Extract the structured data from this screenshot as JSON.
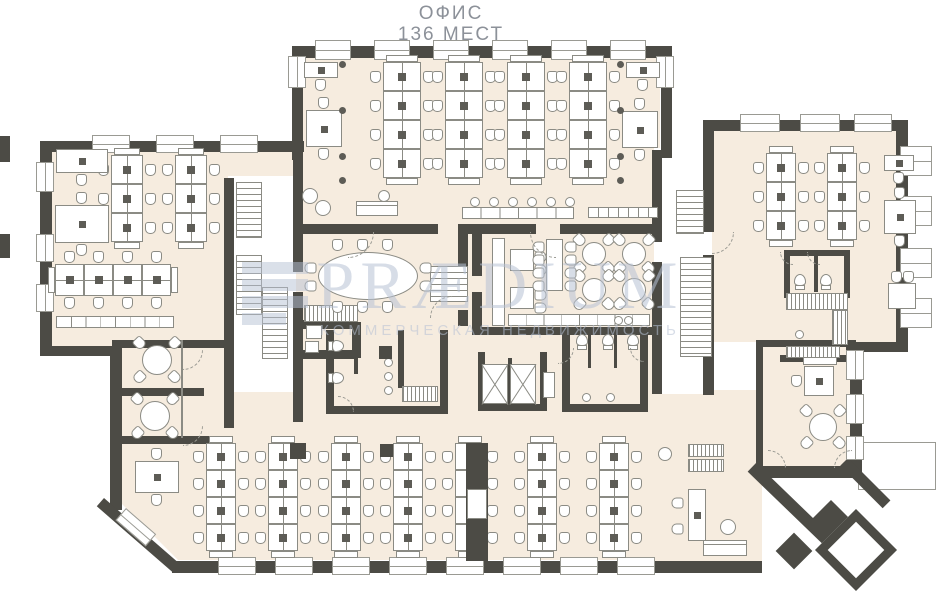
{
  "title": {
    "line1": "ОФИС",
    "line2": "136 МЕСТ"
  },
  "watermark": {
    "brand": "PRÆDIUM",
    "tagline": "КОММЕРЧЕСКАЯ НЕДВИЖИМОСТЬ"
  },
  "colors": {
    "wall": "#4c4b45",
    "floor": "#f6ecdf",
    "line": "#8b8b84",
    "dark": "#5d5c56",
    "watermark": "#b7c2d5",
    "title": "#8c9199",
    "window_line": "#9a9a93"
  },
  "plan": {
    "_format": "arrays are [x,y,w,h]; optional 5th value = rotation in degrees",
    "floors": [
      [
        302,
        56,
        358,
        172
      ],
      [
        50,
        150,
        244,
        200
      ],
      [
        118,
        348,
        112,
        80
      ],
      [
        224,
        390,
        80,
        38
      ],
      [
        296,
        155,
        362,
        270
      ],
      [
        712,
        130,
        190,
        212
      ],
      [
        756,
        342,
        100,
        130
      ],
      [
        650,
        390,
        112,
        172
      ],
      {
        "rect": [
          118,
          418,
          564,
          142
        ],
        "clip": "polygon(0 0,564px 0,564px 142px,60px 142px,0 82px)"
      }
    ],
    "whites": [
      [
        228,
        176,
        66,
        216
      ],
      [
        654,
        148,
        50,
        246
      ]
    ],
    "canopy": [
      858,
      442,
      78,
      48
    ],
    "walls": [
      [
        292,
        46,
        380,
        12
      ],
      [
        292,
        46,
        11,
        114
      ],
      [
        661,
        46,
        11,
        112
      ],
      [
        40,
        141,
        264,
        11
      ],
      [
        40,
        141,
        12,
        215
      ],
      [
        40,
        346,
        80,
        10
      ],
      [
        110,
        348,
        12,
        162
      ],
      [
        104,
        498,
        100,
        11,
        41
      ],
      [
        172,
        561,
        530,
        12
      ],
      [
        688,
        561,
        74,
        12
      ],
      [
        756,
        463,
        158,
        12,
        44
      ],
      [
        703,
        120,
        205,
        11
      ],
      [
        896,
        120,
        12,
        228
      ],
      [
        703,
        120,
        11,
        112
      ],
      [
        703,
        255,
        11,
        140
      ],
      [
        846,
        342,
        62,
        10
      ],
      [
        850,
        342,
        12,
        130
      ],
      [
        762,
        466,
        92,
        12
      ],
      [
        848,
        458,
        60,
        11,
        45
      ],
      [
        224,
        178,
        10,
        250
      ],
      [
        293,
        150,
        10,
        122
      ],
      [
        293,
        292,
        10,
        130
      ],
      [
        296,
        224,
        142,
        10
      ],
      [
        460,
        224,
        76,
        10
      ],
      [
        560,
        224,
        102,
        10
      ],
      [
        458,
        224,
        10,
        70
      ],
      [
        458,
        310,
        10,
        16
      ],
      [
        296,
        320,
        60,
        9
      ],
      [
        352,
        322,
        9,
        36
      ],
      [
        296,
        350,
        58,
        9
      ],
      [
        326,
        330,
        8,
        84
      ],
      [
        326,
        406,
        122,
        8
      ],
      [
        440,
        330,
        8,
        84
      ],
      [
        354,
        330,
        4,
        44
      ],
      [
        398,
        330,
        6,
        58
      ],
      [
        478,
        352,
        7,
        58
      ],
      [
        540,
        352,
        7,
        58
      ],
      [
        478,
        404,
        69,
        7
      ],
      [
        508,
        358,
        4,
        50
      ],
      [
        562,
        330,
        8,
        82
      ],
      [
        562,
        404,
        86,
        8
      ],
      [
        640,
        330,
        8,
        82
      ],
      [
        588,
        330,
        3,
        38
      ],
      [
        614,
        330,
        3,
        38
      ],
      [
        472,
        224,
        10,
        52
      ],
      [
        472,
        292,
        10,
        42
      ],
      [
        472,
        327,
        182,
        8
      ],
      [
        652,
        150,
        10,
        92
      ],
      [
        652,
        262,
        10,
        132
      ],
      [
        784,
        250,
        66,
        6
      ],
      [
        784,
        250,
        6,
        48
      ],
      [
        844,
        250,
        6,
        48
      ],
      [
        814,
        256,
        4,
        36
      ],
      [
        756,
        340,
        100,
        7
      ],
      [
        756,
        340,
        7,
        132
      ],
      [
        780,
        355,
        72,
        7
      ],
      [
        112,
        340,
        118,
        8
      ],
      [
        112,
        388,
        92,
        8
      ],
      [
        112,
        436,
        120,
        8
      ]
    ],
    "windows": [
      [
        315,
        40,
        36,
        20
      ],
      [
        374,
        40,
        36,
        20
      ],
      [
        433,
        40,
        36,
        20
      ],
      [
        492,
        40,
        36,
        20
      ],
      [
        551,
        40,
        36,
        20
      ],
      [
        610,
        40,
        36,
        20
      ],
      [
        92,
        135,
        38,
        18
      ],
      [
        156,
        135,
        38,
        18
      ],
      [
        220,
        135,
        38,
        18
      ],
      [
        740,
        114,
        40,
        18
      ],
      [
        800,
        114,
        40,
        18
      ],
      [
        854,
        114,
        38,
        18
      ],
      [
        218,
        557,
        38,
        18
      ],
      [
        275,
        557,
        38,
        18
      ],
      [
        332,
        557,
        38,
        18
      ],
      [
        389,
        557,
        38,
        18
      ],
      [
        446,
        557,
        38,
        18
      ],
      [
        503,
        557,
        38,
        18
      ],
      [
        560,
        557,
        38,
        18
      ],
      [
        617,
        557,
        38,
        18
      ],
      [
        36,
        162,
        18,
        30
      ],
      [
        36,
        234,
        18,
        28
      ],
      [
        36,
        284,
        18,
        28
      ],
      [
        288,
        56,
        18,
        32
      ],
      [
        656,
        56,
        18,
        32
      ],
      [
        900,
        146,
        32,
        30
      ],
      [
        900,
        196,
        32,
        30
      ],
      [
        900,
        248,
        32,
        30
      ],
      [
        900,
        298,
        32,
        30
      ],
      [
        846,
        350,
        18,
        30
      ],
      [
        846,
        394,
        18,
        30
      ],
      [
        846,
        436,
        18,
        24
      ],
      [
        126,
        508,
        40,
        16,
        41
      ]
    ],
    "stairs": [
      [
        236,
        182,
        26,
        56
      ],
      [
        236,
        255,
        26,
        60
      ],
      [
        262,
        287,
        26,
        72
      ],
      [
        430,
        266,
        38,
        36
      ],
      [
        676,
        190,
        28,
        44
      ],
      [
        680,
        257,
        32,
        100
      ]
    ],
    "benches": {
      "_format": "[x,y,rows,width,rowHeight]",
      "items": [
        [
          383,
          62,
          4,
          38,
          29
        ],
        [
          445,
          62,
          4,
          38,
          29
        ],
        [
          507,
          62,
          4,
          38,
          29
        ],
        [
          569,
          62,
          4,
          38,
          29
        ],
        [
          111,
          155,
          3,
          32,
          29
        ],
        [
          175,
          155,
          3,
          32,
          29
        ],
        [
          766,
          153,
          3,
          30,
          29
        ],
        [
          827,
          153,
          3,
          30,
          29
        ],
        [
          206,
          443,
          4,
          30,
          27
        ],
        [
          268,
          443,
          4,
          30,
          27
        ],
        [
          331,
          443,
          4,
          30,
          27
        ],
        [
          393,
          443,
          4,
          30,
          27
        ],
        [
          455,
          443,
          4,
          30,
          27
        ],
        [
          527,
          443,
          4,
          30,
          27
        ],
        [
          599,
          443,
          4,
          30,
          27
        ]
      ]
    },
    "hbenches": {
      "_format": "[x,y,cols,colWidth,height]",
      "items": [
        [
          55,
          264,
          4,
          29,
          32
        ]
      ]
    },
    "desks": {
      "_format": "[x,y,w,h,[chair sides t/b/l/r],monitor]",
      "items": [
        [
          304,
          62,
          34,
          16,
          [
            "b"
          ],
          1
        ],
        [
          306,
          110,
          36,
          37,
          [
            "t",
            "b"
          ],
          1
        ],
        [
          626,
          62,
          34,
          16,
          [
            "b"
          ],
          1
        ],
        [
          622,
          111,
          36,
          37,
          [
            "t",
            "b"
          ],
          1
        ],
        [
          56,
          149,
          52,
          24,
          [
            "b"
          ],
          1
        ],
        [
          55,
          205,
          54,
          38,
          [
            "t",
            "b"
          ],
          1
        ],
        [
          884,
          155,
          30,
          16,
          [
            "b"
          ],
          1
        ],
        [
          884,
          200,
          32,
          34,
          [
            "t",
            "b"
          ],
          1
        ],
        [
          135,
          461,
          44,
          32,
          [
            "t",
            "b"
          ],
          1
        ],
        [
          804,
          366,
          30,
          30,
          [
            "l"
          ],
          1
        ],
        [
          688,
          489,
          18,
          52,
          [],
          1
        ],
        [
          888,
          283,
          28,
          26,
          [],
          0
        ],
        [
          510,
          249,
          24,
          22,
          [],
          0
        ],
        [
          510,
          287,
          24,
          22,
          [],
          0
        ]
      ]
    },
    "chairs": [
      [
        672,
        497,
        90
      ],
      [
        672,
        523,
        90
      ],
      [
        891,
        271,
        0
      ],
      [
        903,
        271,
        0
      ],
      [
        535,
        251,
        -90
      ],
      [
        535,
        264,
        -90
      ],
      [
        535,
        289,
        -90
      ],
      [
        535,
        302,
        -90
      ]
    ],
    "round_tables": [
      [
        157,
        360,
        15
      ],
      [
        155,
        416,
        15
      ],
      [
        594,
        254,
        12
      ],
      [
        634,
        254,
        12
      ],
      [
        594,
        290,
        12
      ],
      [
        634,
        290,
        12
      ],
      [
        823,
        427,
        14
      ]
    ],
    "oval_table": [
      318,
      252,
      100,
      48
    ],
    "long_table": [
      546,
      239,
      17,
      52
    ],
    "counters": {
      "_format": "[x,y,w,h,segments]",
      "items": [
        [
          462,
          207,
          112,
          12,
          6
        ],
        [
          588,
          207,
          70,
          11,
          7
        ],
        [
          56,
          316,
          118,
          12,
          8
        ],
        [
          492,
          238,
          13,
          88,
          0
        ],
        [
          508,
          314,
          142,
          12,
          8
        ],
        [
          803,
          357,
          34,
          8,
          0
        ]
      ]
    },
    "hatches": [
      [
        304,
        305,
        54,
        17
      ],
      [
        786,
        293,
        62,
        17
      ],
      [
        786,
        346,
        54,
        12
      ],
      [
        832,
        310,
        16,
        35
      ],
      [
        688,
        444,
        36,
        13
      ],
      [
        688,
        459,
        36,
        13
      ],
      [
        402,
        386,
        36,
        16
      ]
    ],
    "elevators": [
      [
        482,
        364,
        26,
        40
      ],
      [
        510,
        364,
        26,
        40
      ]
    ],
    "toilets": [
      [
        330,
        338,
        -90
      ],
      [
        330,
        370,
        -90
      ],
      [
        576,
        334,
        180
      ],
      [
        602,
        334,
        180
      ],
      [
        627,
        334,
        180
      ],
      [
        794,
        274,
        180
      ],
      [
        820,
        274,
        180
      ]
    ],
    "sinks": [
      [
        384,
        358
      ],
      [
        384,
        372
      ],
      [
        384,
        386
      ],
      [
        582,
        393
      ],
      [
        606,
        393
      ],
      [
        795,
        330
      ],
      [
        614,
        316
      ],
      [
        624,
        316
      ]
    ],
    "sofas": [
      [
        356,
        201,
        42,
        15
      ],
      [
        703,
        540,
        44,
        16
      ]
    ],
    "poufs": [
      [
        310,
        196,
        8
      ],
      [
        323,
        208,
        8
      ],
      [
        384,
        196,
        6
      ],
      [
        728,
        527,
        8
      ],
      [
        665,
        454,
        7
      ]
    ],
    "stools": {
      "y": 197,
      "r": 5,
      "xs": [
        470,
        489,
        508,
        527,
        546,
        565
      ]
    },
    "boxes": [
      [
        306,
        325,
        16,
        14
      ],
      [
        305,
        341,
        14,
        12
      ],
      [
        543,
        372,
        12,
        26
      ]
    ],
    "columns": [
      [
        290,
        443,
        16,
        16
      ],
      [
        380,
        444,
        13,
        13
      ],
      [
        379,
        346,
        13,
        13
      ],
      [
        466,
        443,
        22,
        118
      ],
      [
        0,
        136,
        10,
        26
      ],
      [
        0,
        234,
        10,
        24
      ]
    ],
    "pillar_tables": [
      [
        467,
        489,
        20,
        30
      ]
    ],
    "dots": [
      [
        342,
        64
      ],
      [
        342,
        110
      ],
      [
        342,
        156
      ],
      [
        342,
        180
      ],
      [
        620,
        64
      ],
      [
        620,
        110
      ],
      [
        620,
        156
      ],
      [
        620,
        180
      ]
    ],
    "glass_lines": [
      [
        181,
        340,
        2,
        98
      ]
    ],
    "arcs": {
      "_format": "[hingeX,hingeY,radius,quadrant]",
      "items": [
        [
          348,
          232,
          26,
          "br"
        ],
        [
          556,
          232,
          26,
          "bl"
        ],
        [
          452,
          318,
          22,
          "tl"
        ],
        [
          183,
          350,
          20,
          "br"
        ],
        [
          183,
          426,
          20,
          "br"
        ],
        [
          338,
          412,
          16,
          "tr"
        ],
        [
          558,
          348,
          16,
          "br"
        ],
        [
          644,
          348,
          14,
          "bl"
        ],
        [
          712,
          232,
          22,
          "br"
        ],
        [
          793,
          252,
          13,
          "bl"
        ],
        [
          820,
          252,
          13,
          "bl"
        ],
        [
          768,
          468,
          18,
          "tr"
        ],
        [
          852,
          468,
          18,
          "tl"
        ]
      ]
    },
    "diamonds": {
      "_format": "[cx,cy,size,filled,borderWidth]",
      "items": [
        [
          831,
          524,
          34,
          1,
          0
        ],
        [
          794,
          551,
          26,
          1,
          0
        ],
        [
          856,
          550,
          58,
          0,
          9
        ]
      ]
    }
  }
}
